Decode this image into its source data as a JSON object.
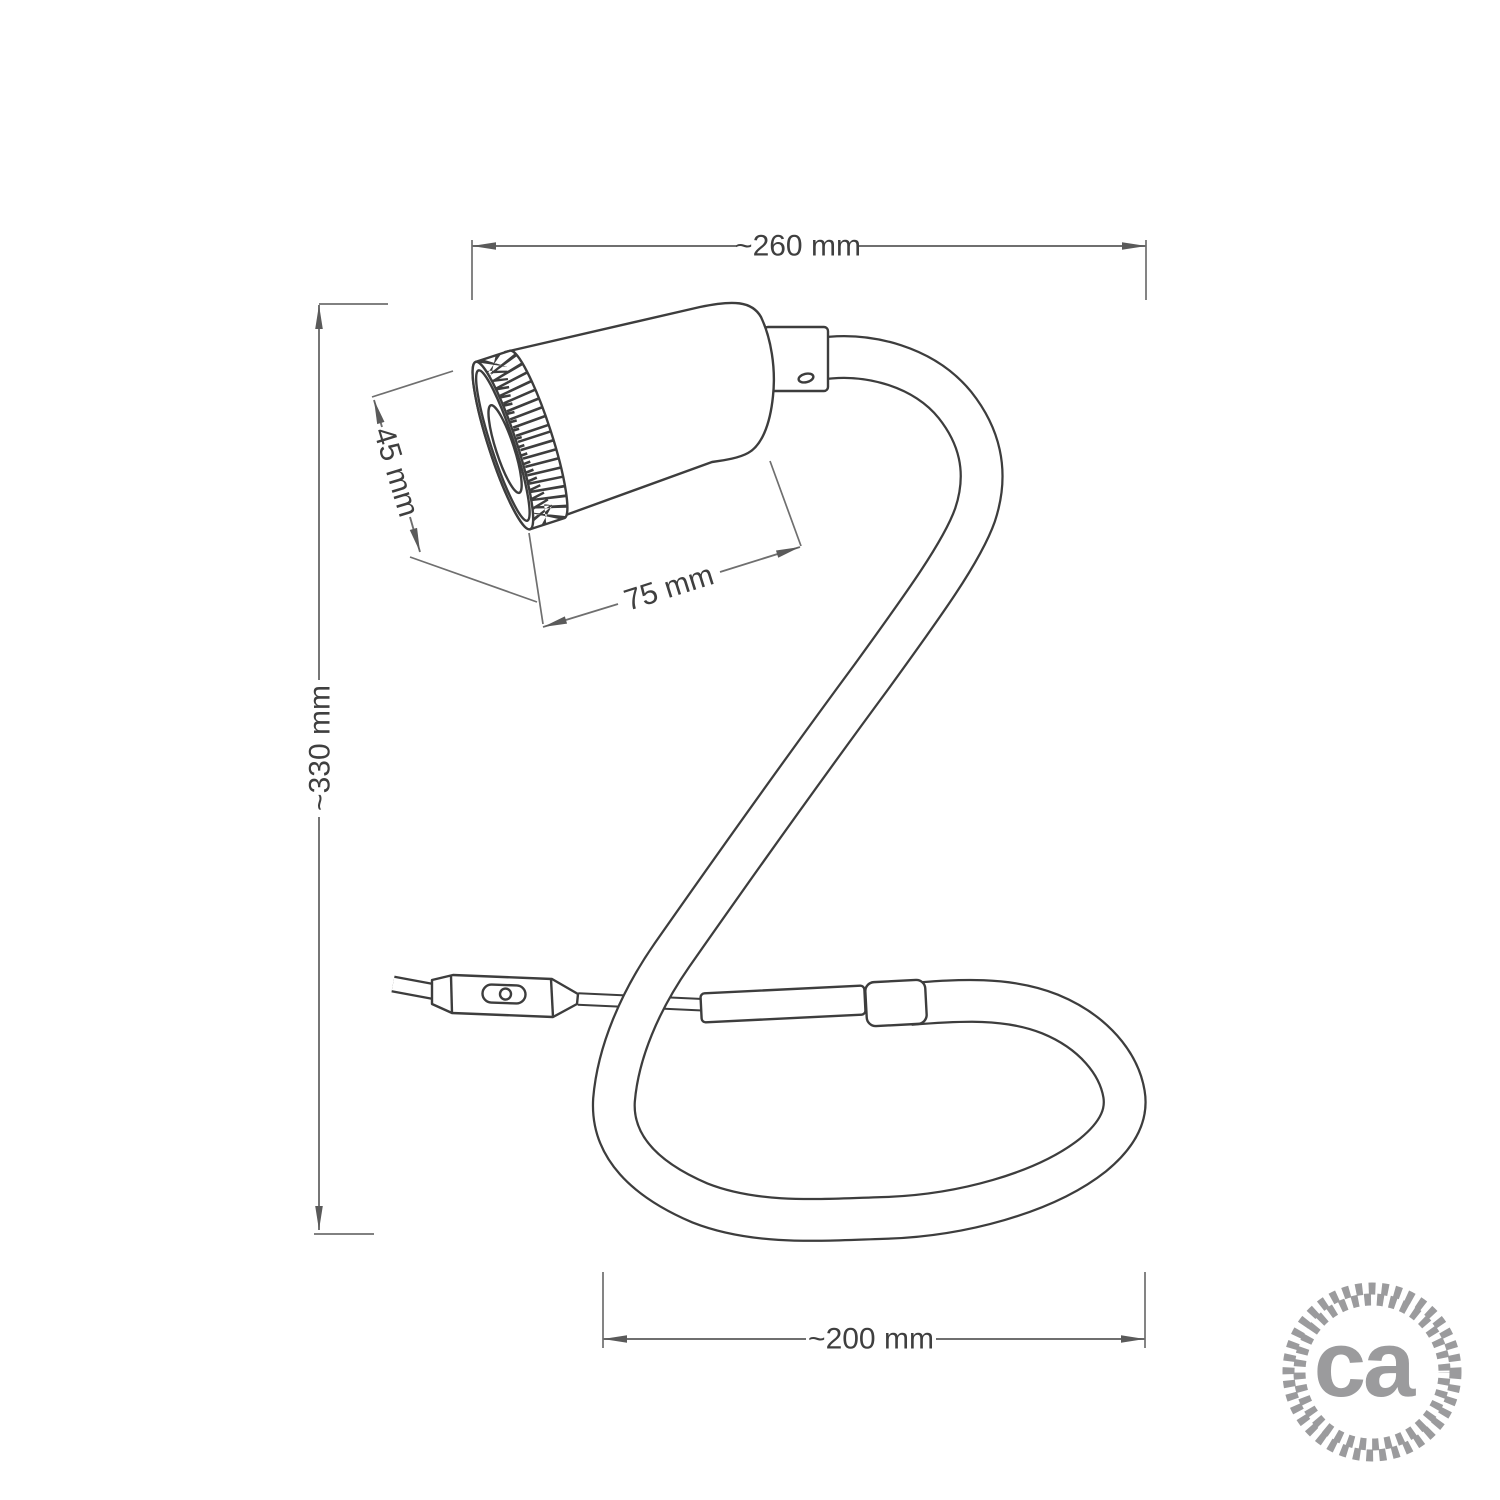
{
  "drawing": {
    "title": "gooseneck-spotlight-table-lamp-technical-drawing",
    "dimensions": {
      "overall_width": "~260 mm",
      "overall_height": "~330 mm",
      "head_diameter": "45 mm",
      "head_length": "75 mm",
      "base_loop_width": "~200 mm"
    },
    "parts": {
      "lamp_head": "cylindrical spotlight head with knurled bezel",
      "gooseneck": "flexible tube bent in S-shape with bottom loop",
      "switch": "inline cord switch",
      "cord": "power cord",
      "sleeve": "cable transition sleeve",
      "ring": "tube end ring"
    },
    "logo": {
      "text": "ca"
    },
    "colors": {
      "background": "#ffffff",
      "outline": "#3d3d3d",
      "dimension_line": "#6f6f6f",
      "dimension_text": "#3f3f3f",
      "logo_gray": "#9b9b9d"
    }
  }
}
